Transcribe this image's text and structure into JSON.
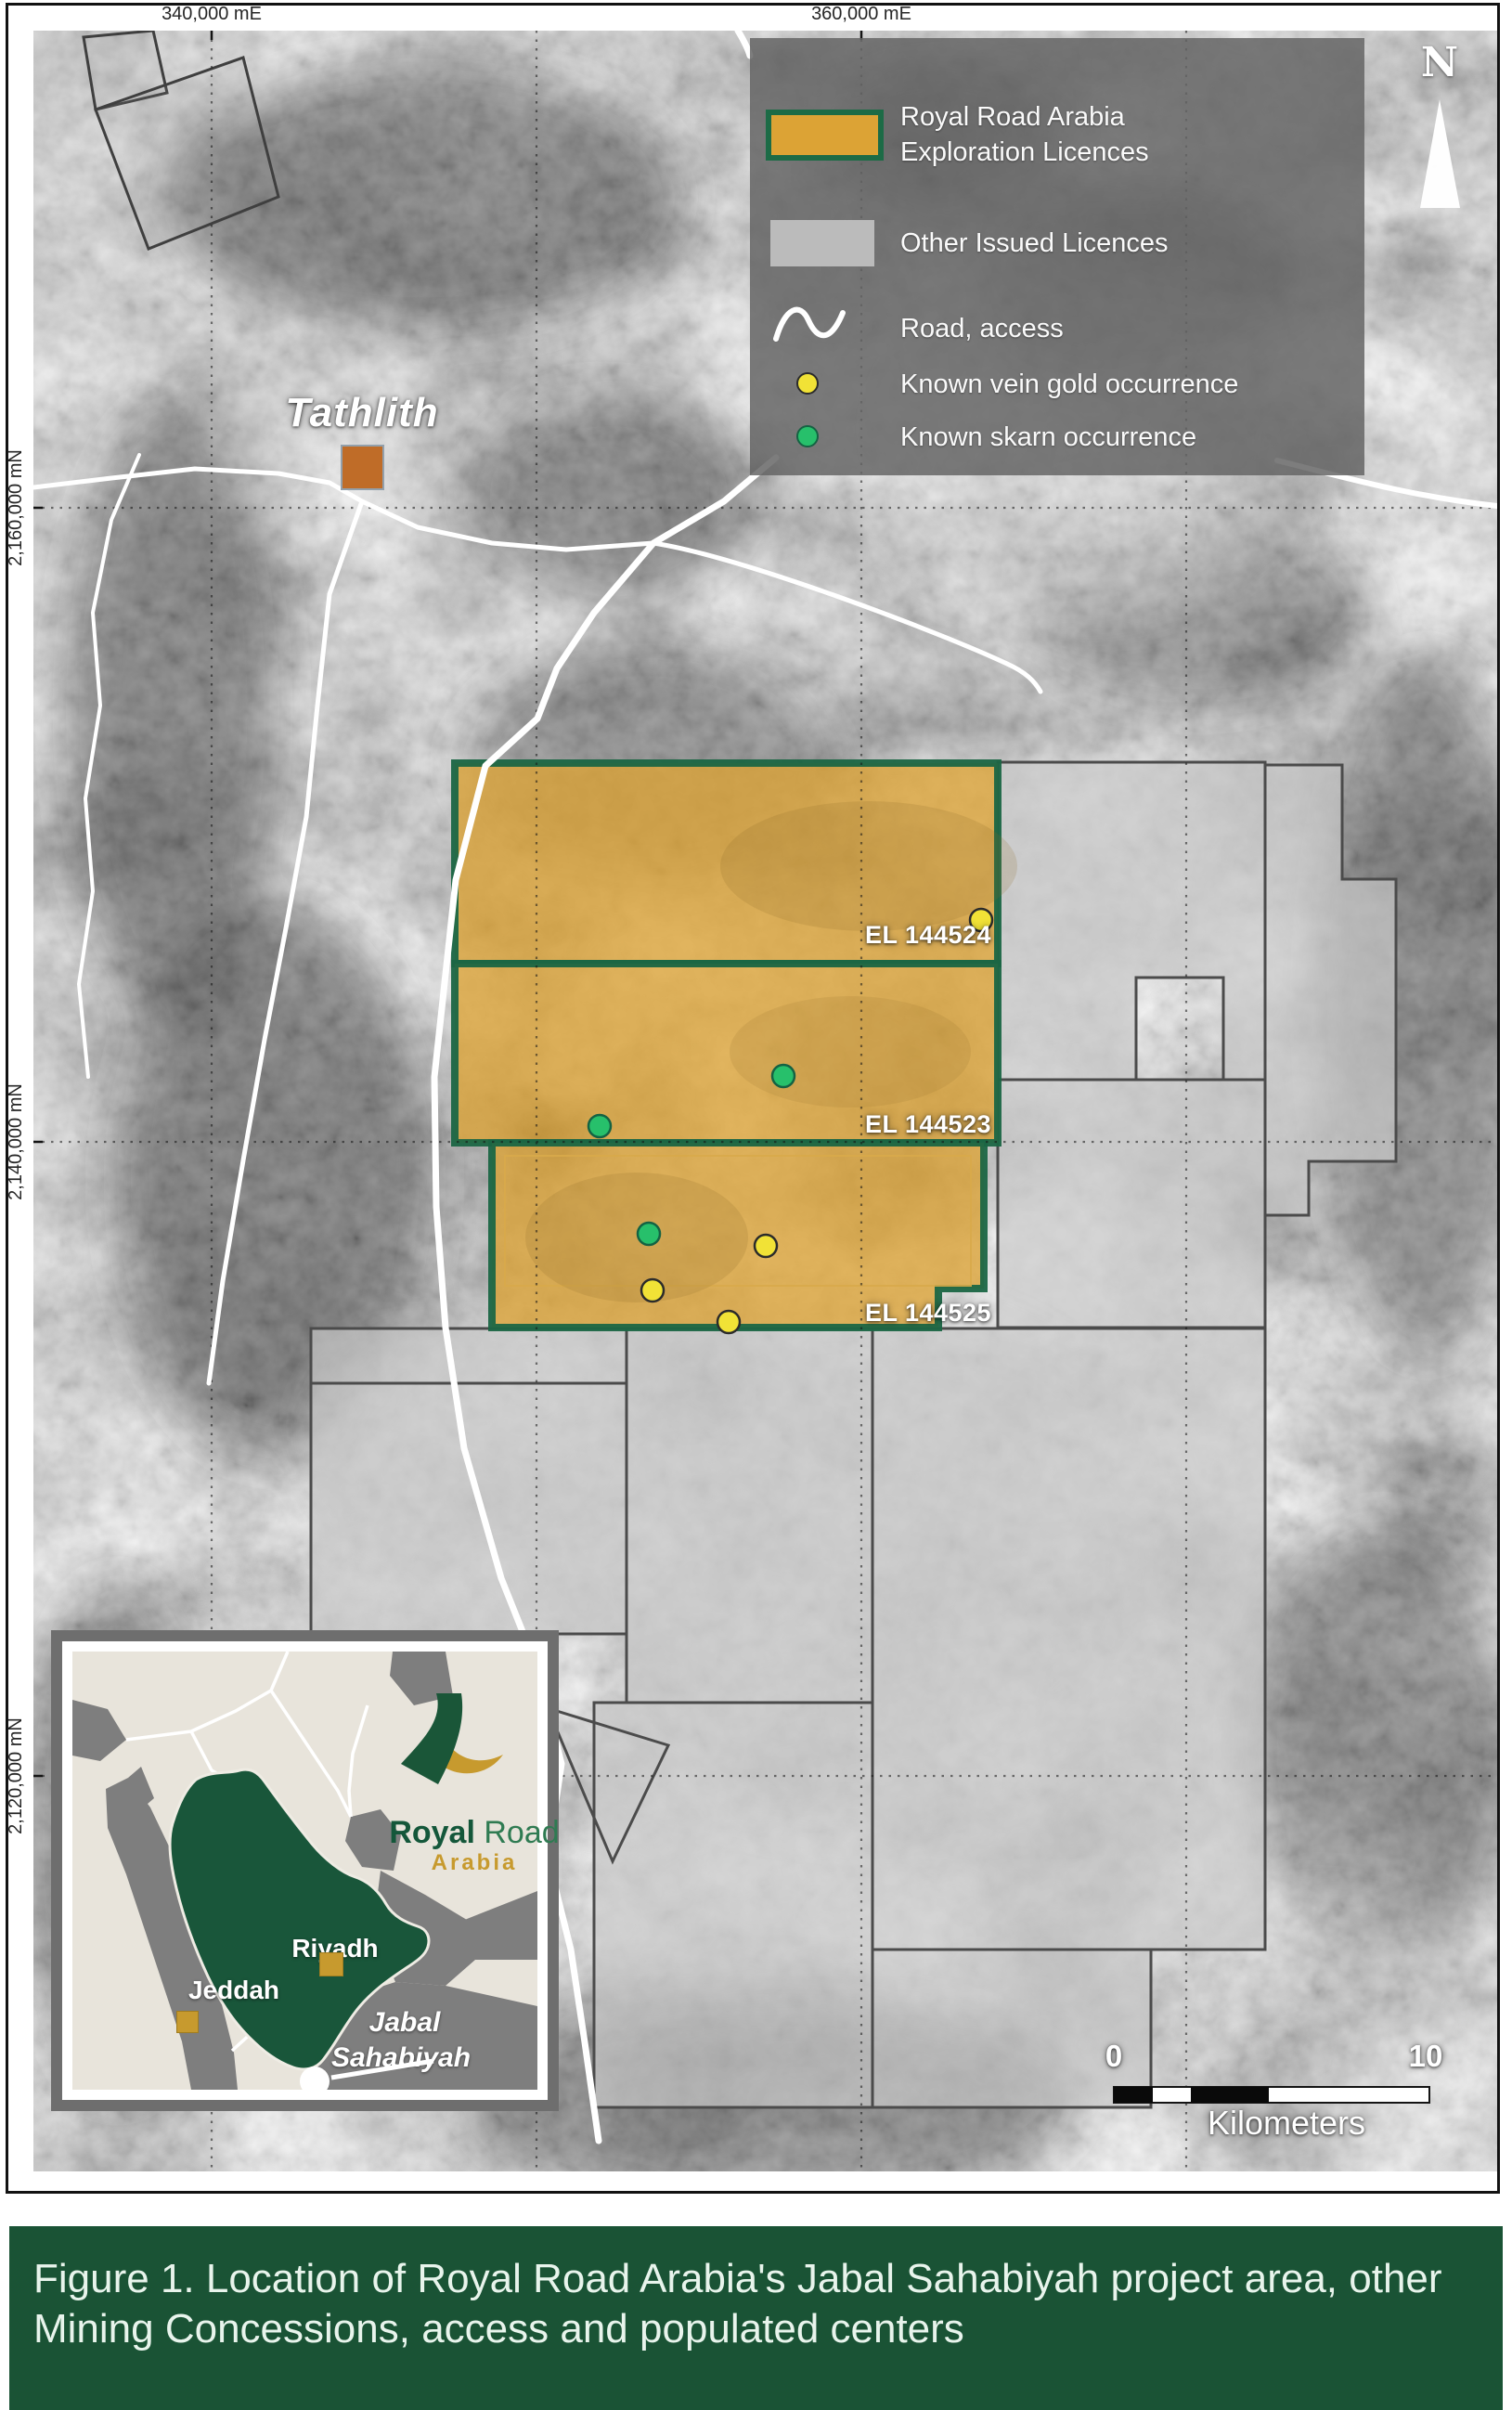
{
  "figure": {
    "caption": "Figure 1. Location of Royal Road Arabia's Jabal Sahabiyah project area, other Mining Concessions, access and populated centers"
  },
  "axes": {
    "top": [
      "340,000 mE",
      "360,000 mE"
    ],
    "left": [
      "2,160,000 mN",
      "2,140,000 mN",
      "2,120,000 mN"
    ]
  },
  "legend": {
    "items": [
      {
        "swatch": "rra-licence-swatch",
        "line1": "Royal Road Arabia",
        "line2": "Exploration Licences"
      },
      {
        "swatch": "other-licence-swatch",
        "label": "Other Issued Licences"
      },
      {
        "swatch": "road-swatch",
        "label": "Road, access"
      },
      {
        "swatch": "gold-occurrence-dot",
        "label": "Known vein gold occurrence"
      },
      {
        "swatch": "skarn-occurrence-dot",
        "label": "Known skarn occurrence"
      }
    ]
  },
  "map": {
    "town": "Tathlith",
    "north": "N",
    "licences": [
      "EL 144524",
      "EL 144523",
      "EL 144525"
    ]
  },
  "scalebar": {
    "start": "0",
    "end": "10",
    "unit": "Kilometers"
  },
  "inset": {
    "logo": {
      "word1": "Royal",
      "word2": "Road",
      "sub": "Arabia"
    },
    "cities": [
      "Riyadh",
      "Jeddah"
    ],
    "project": {
      "line1": "Jabal",
      "line2": "Sahabiyah"
    }
  },
  "colors": {
    "rra_licence_fill": "#DCA335",
    "licence_border_green": "#1C6B46",
    "other_licence_fill": "#C3C3C3",
    "gold_occurrence": "#F1E236",
    "skarn_occurrence": "#27C06B",
    "road": "#FFFFFF",
    "caption_bg": "#1A5335",
    "brand_green": "#1A5638",
    "brand_gold": "#C79A2E",
    "town_marker": "#BF6C28"
  }
}
